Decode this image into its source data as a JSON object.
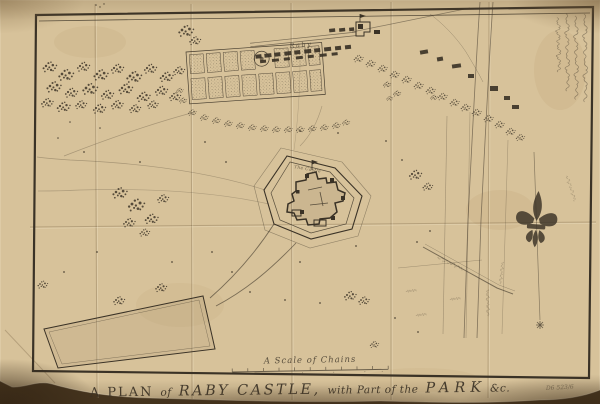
{
  "colors": {
    "backdrop": "#46351f",
    "paper": "#d7c29a",
    "paper_shade": "#c2a97c",
    "ink": "#3a3226",
    "ink_soft": "#55483a",
    "ink_faint": "#7a6a50",
    "title_ink": "#453b2c"
  },
  "map": {
    "title": {
      "full": "A PLAN of RABY CASTLE, with Part of the PARK &c.",
      "t1": "A PLAN",
      "t2": "of",
      "t3": "RABY CASTLE,",
      "t4": "with Part of the",
      "t5": "PARK",
      "t6": "&c."
    },
    "scale": {
      "label": "A Scale of Chains"
    },
    "labels": {
      "village": "Raby",
      "castle": "The Castle",
      "reference_number": "D6 523/6"
    },
    "compass": {
      "symbol": "fleur-de-lis",
      "direction": "north"
    },
    "icons": {
      "compass": "fleur-de-lis-icon",
      "south_mark": "star-icon",
      "annotation": "handwritten-note"
    }
  }
}
